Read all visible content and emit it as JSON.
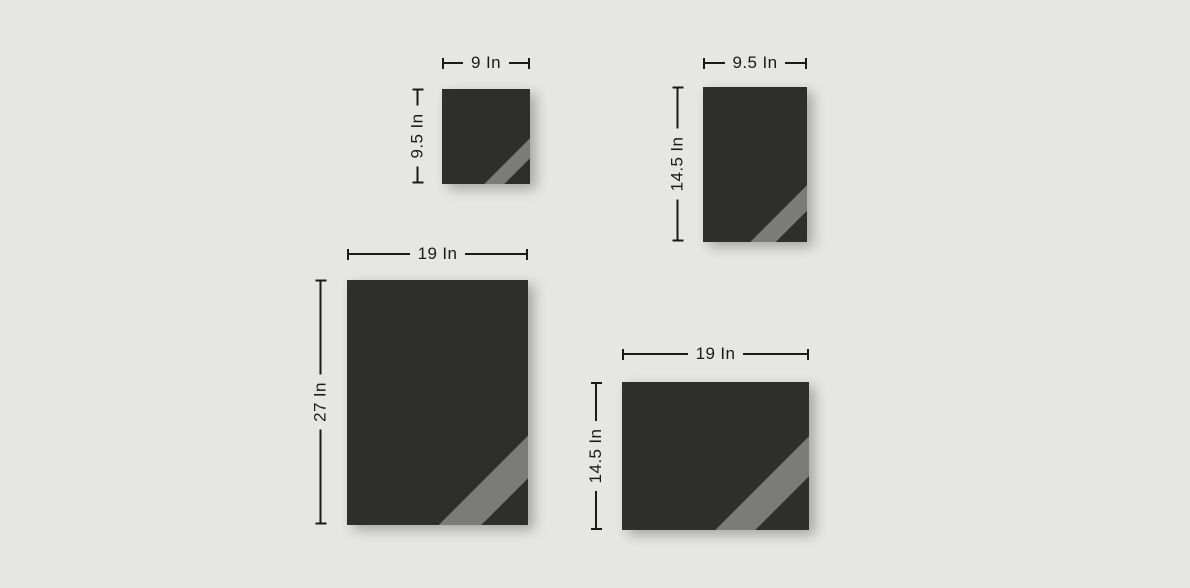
{
  "palette": {
    "background": "#e6e6e5",
    "swatch_fill": "#2e2e2d",
    "stripe": "#7b7b7a",
    "line": "#1a1a1a"
  },
  "items": [
    {
      "name": "small-square",
      "width_label": "9 In",
      "height_label": "9.5 In",
      "width_in": 9,
      "height_in": 9.5
    },
    {
      "name": "small-portrait",
      "width_label": "9.5 In",
      "height_label": "14.5 In",
      "width_in": 9.5,
      "height_in": 14.5
    },
    {
      "name": "large-portrait",
      "width_label": "19 In",
      "height_label": "27 In",
      "width_in": 19,
      "height_in": 27
    },
    {
      "name": "wide-landscape",
      "width_label": "19 In",
      "height_label": "14.5 In",
      "width_in": 19,
      "height_in": 14.5
    }
  ]
}
